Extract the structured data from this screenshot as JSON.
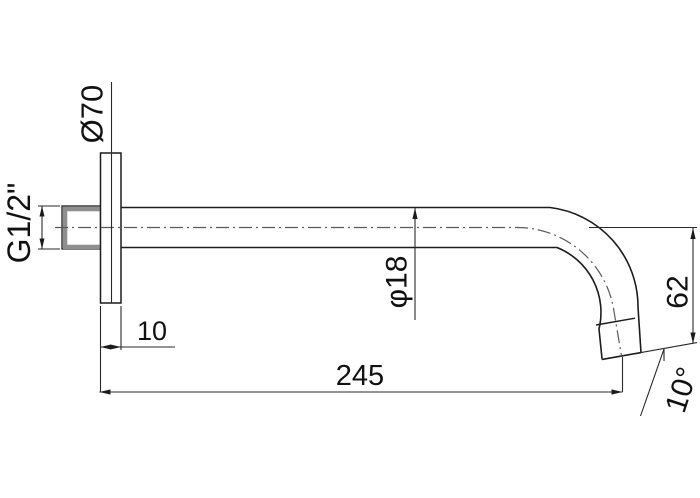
{
  "drawing": {
    "kind": "technical-dimension-drawing",
    "labels": {
      "flange_diameter": "Ø70",
      "thread_size": "G1/2\"",
      "flange_offset": "10",
      "arm_length": "245",
      "pipe_diameter": "φ18",
      "drop_height": "62",
      "tip_angle": "10°"
    },
    "colors": {
      "background": "#ffffff",
      "object_line": "#1c1c1c",
      "dimension_line": "#2a2a2a",
      "centerline": "#5a5a5a",
      "thread_shading": "#8f8f8f",
      "text": "#111111"
    }
  }
}
